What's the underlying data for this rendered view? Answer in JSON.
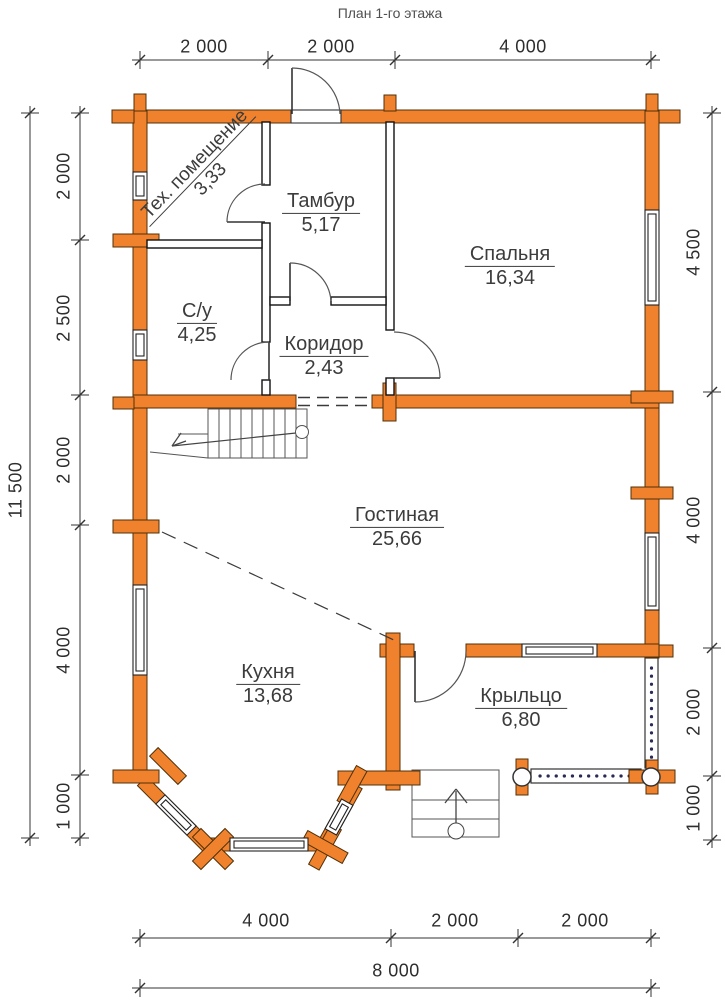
{
  "title": "План 1-го этажа",
  "rooms": [
    {
      "name": "Тех. помещение",
      "area": "3,33"
    },
    {
      "name": "Тамбур",
      "area": "5,17"
    },
    {
      "name": "Спальня",
      "area": "16,34"
    },
    {
      "name": "С/у",
      "area": "4,25"
    },
    {
      "name": "Коридор",
      "area": "2,43"
    },
    {
      "name": "Гостиная",
      "area": "25,66"
    },
    {
      "name": "Кухня",
      "area": "13,68"
    },
    {
      "name": "Крыльцо",
      "area": "6,80"
    }
  ],
  "dimensions": {
    "top": [
      "2 000",
      "2 000",
      "4 000"
    ],
    "left": [
      "2 000",
      "2 500",
      "2 000",
      "4 000",
      "1 000"
    ],
    "left_total": "11 500",
    "right": [
      "4 500",
      "4 000",
      "2 000",
      "1 000"
    ],
    "bottom": [
      "4 000",
      "2 000",
      "2 000"
    ],
    "bottom_total": "8 000"
  },
  "colors": {
    "wall_fill": "#f0822d",
    "wall_outline": "#503008",
    "partition": "#111111",
    "text": "#3c3c3c",
    "dimension_text": "#2e2e2e"
  }
}
